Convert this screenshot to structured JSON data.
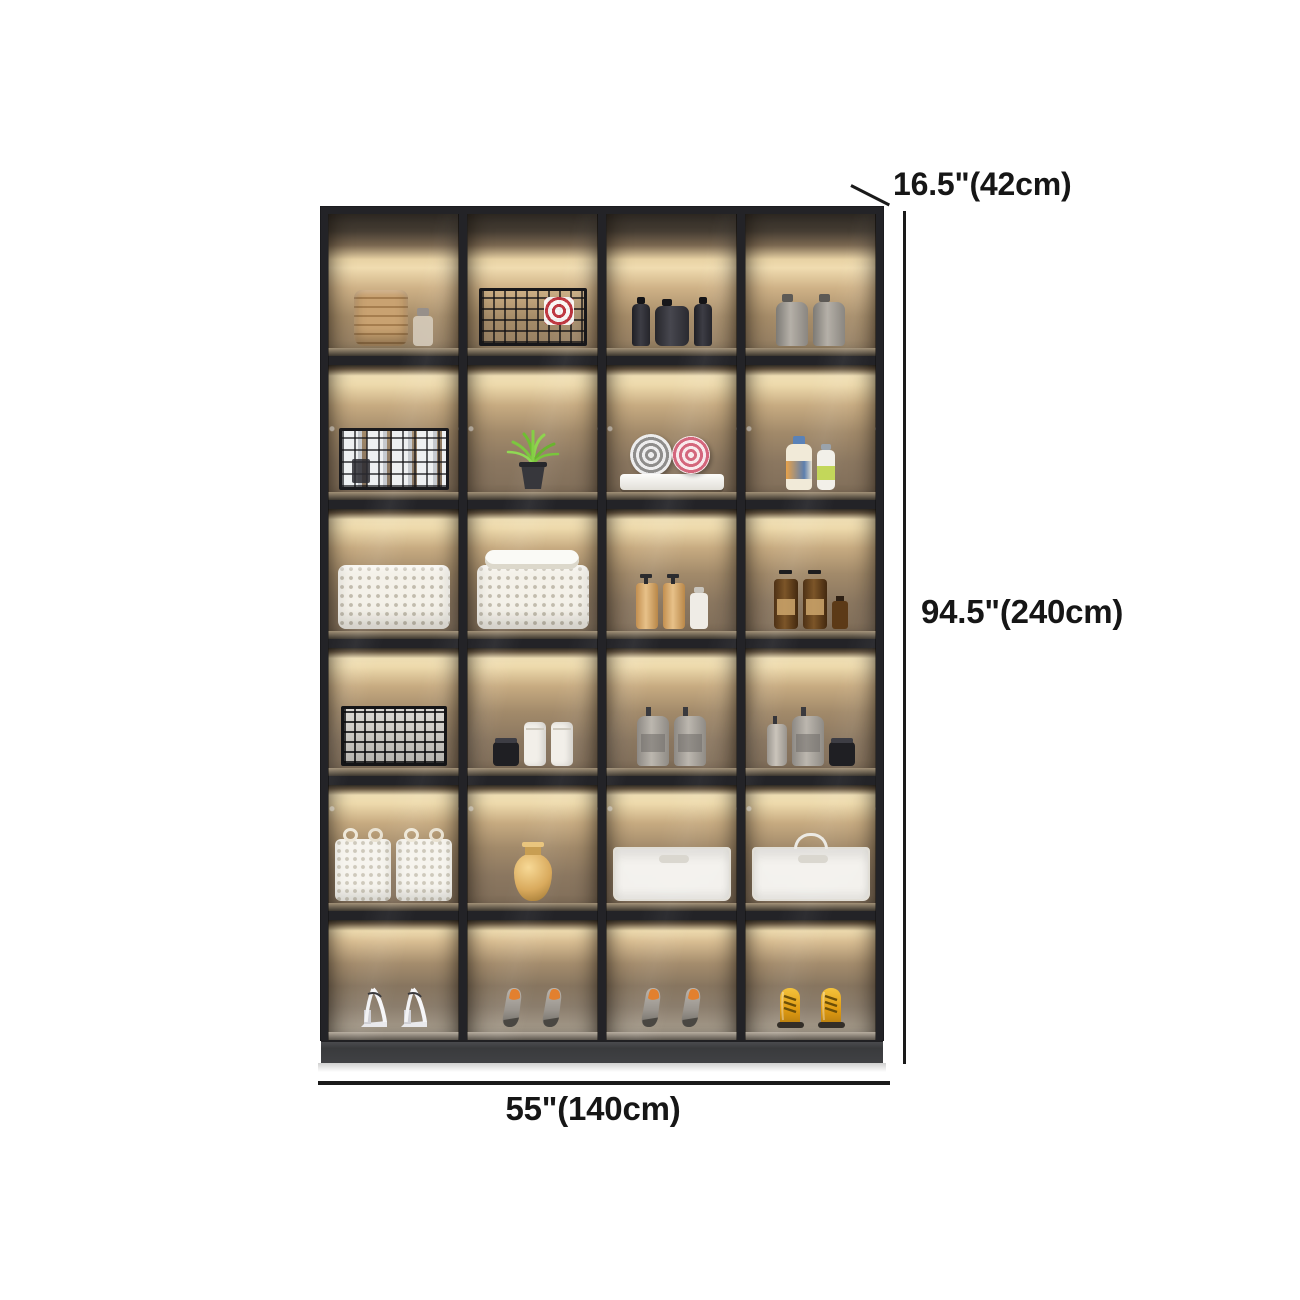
{
  "dimensions": {
    "depth_label": "16.5\"(42cm)",
    "height_label": "94.5\"(240cm)",
    "width_label": "55\"(140cm)"
  },
  "colors": {
    "background": "#ffffff",
    "cabinet_frame": "#232327",
    "shelf_glow": "#f1e0b6",
    "dimension_text": "#161616",
    "boot_yellow": "#e8a81c",
    "insole_orange": "#e2802f"
  },
  "cabinet": {
    "columns": 4,
    "rows": 6,
    "cells": [
      {
        "row": 1,
        "col": 1,
        "items": [
          "basket-tan",
          "glass-jar"
        ]
      },
      {
        "row": 1,
        "col": 2,
        "items": [
          "wire-basket-cloth"
        ]
      },
      {
        "row": 1,
        "col": 3,
        "items": [
          "bottle-dark",
          "jug-dark",
          "bottle-dark"
        ]
      },
      {
        "row": 1,
        "col": 4,
        "items": [
          "jug-grey",
          "jug-grey"
        ]
      },
      {
        "row": 2,
        "col": 1,
        "items": [
          "wire-basket-bottles"
        ]
      },
      {
        "row": 2,
        "col": 2,
        "items": [
          "plant"
        ]
      },
      {
        "row": 2,
        "col": 3,
        "items": [
          "towel-rolls"
        ]
      },
      {
        "row": 2,
        "col": 4,
        "items": [
          "shampoo-orange",
          "shampoo-green"
        ]
      },
      {
        "row": 3,
        "col": 1,
        "items": [
          "basket-white"
        ]
      },
      {
        "row": 3,
        "col": 2,
        "items": [
          "basket-white-towels"
        ]
      },
      {
        "row": 3,
        "col": 3,
        "items": [
          "pump-amber",
          "pump-amber",
          "bottle-white-sm"
        ]
      },
      {
        "row": 3,
        "col": 4,
        "items": [
          "pump-brown",
          "pump-brown",
          "bottle-brown-sm"
        ]
      },
      {
        "row": 4,
        "col": 1,
        "items": [
          "grid-basket"
        ]
      },
      {
        "row": 4,
        "col": 2,
        "items": [
          "jar-black",
          "canister-white",
          "canister-white"
        ]
      },
      {
        "row": 4,
        "col": 3,
        "items": [
          "laundry-grey",
          "laundry-grey"
        ]
      },
      {
        "row": 4,
        "col": 4,
        "items": [
          "pump-grey-sm",
          "laundry-grey",
          "jar-black"
        ]
      },
      {
        "row": 5,
        "col": 1,
        "items": [
          "woven-bag",
          "woven-bag"
        ]
      },
      {
        "row": 5,
        "col": 2,
        "items": [
          "vase-gold"
        ]
      },
      {
        "row": 5,
        "col": 3,
        "items": [
          "bin-white"
        ]
      },
      {
        "row": 5,
        "col": 4,
        "items": [
          "bin-white-lid"
        ]
      },
      {
        "row": 6,
        "col": 1,
        "items": [
          "heels-white"
        ]
      },
      {
        "row": 6,
        "col": 2,
        "items": [
          "pumps-grey"
        ]
      },
      {
        "row": 6,
        "col": 3,
        "items": [
          "pumps-grey"
        ]
      },
      {
        "row": 6,
        "col": 4,
        "items": [
          "boots-yellow"
        ]
      }
    ]
  }
}
